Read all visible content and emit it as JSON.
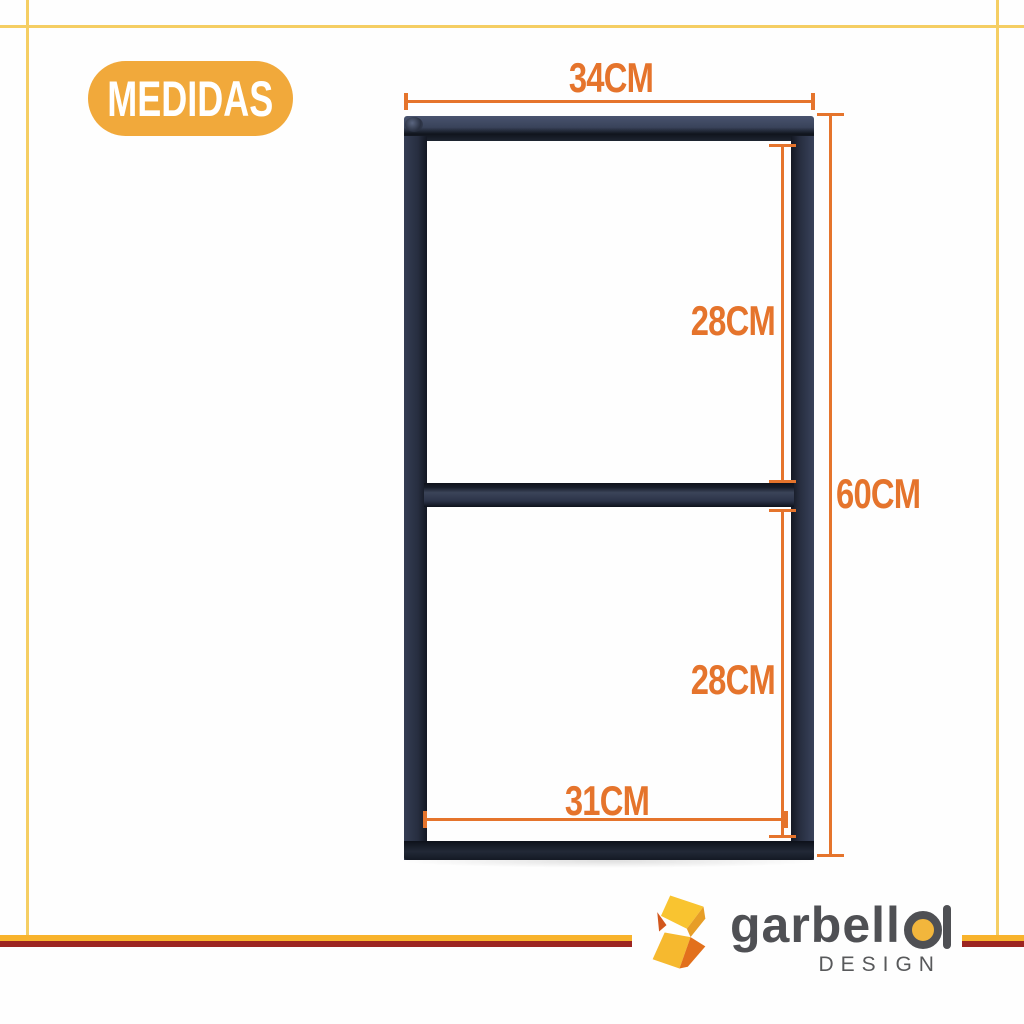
{
  "badge": {
    "label": "MEDIDAS"
  },
  "measurements": {
    "top_width": "34CM",
    "upper_section_height": "28CM",
    "total_height": "60CM",
    "lower_section_height": "28CM",
    "bottom_width": "31CM"
  },
  "logo": {
    "brand_prefix": "garbell",
    "brand_last_letter": "a",
    "tagline": "DESIGN"
  },
  "colors": {
    "dimension_accent": "#E5742C",
    "badge_background": "#F1A93B",
    "badge_text": "#FFFFFF",
    "border_line_yellow": "#F5CE63",
    "footer_stripe_top": "#F8B32C",
    "footer_stripe_bottom": "#9C2521",
    "frame_metal_highlight": "#3B4459",
    "frame_metal_shadow": "#10141D",
    "logo_text_gray": "#4F5054",
    "logo_accent_yellow": "#F2B63C"
  }
}
